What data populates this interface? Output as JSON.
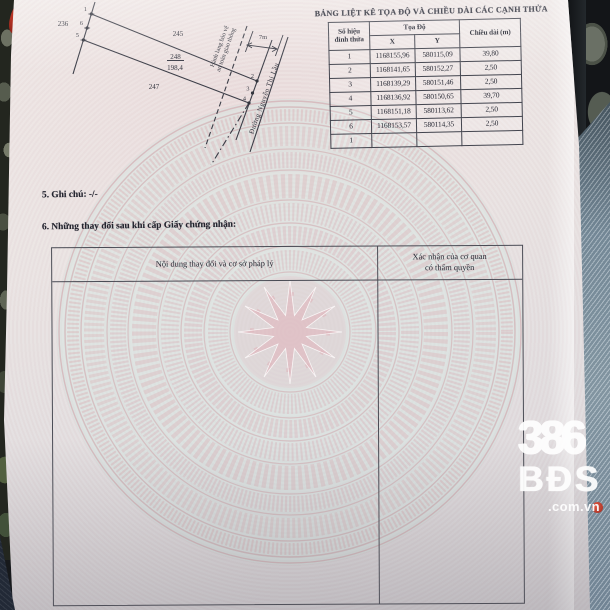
{
  "map": {
    "adjacent_left": "236",
    "adjacent_top": "245",
    "adjacent_bottom": "247",
    "parcel_number": "248",
    "parcel_area": "198,4",
    "road_width": "7m",
    "corridor_line1": "Hành lang bảo vệ",
    "corridor_line2": "an toàn giao thông",
    "road_name": "Đường Nguyễn Thị Lầu",
    "v1": "1",
    "v2": "2",
    "v3": "3",
    "v4": "4",
    "v5": "5",
    "v6": "6"
  },
  "coord_table": {
    "title": "BẢNG LIỆT KÊ TỌA ĐỘ VÀ CHIỀU DÀI CÁC CẠNH THỬA",
    "col_vertex_line1": "Số hiệu",
    "col_vertex_line2": "đỉnh thửa",
    "col_coords": "Tọa Độ",
    "col_x": "X",
    "col_y": "Y",
    "col_length": "Chiều dài (m)",
    "rows": [
      {
        "no": "1",
        "x": "1168155,96",
        "y": "580115,09",
        "len": "39,80"
      },
      {
        "no": "2",
        "x": "1168141,65",
        "y": "580152,27",
        "len": "2,50"
      },
      {
        "no": "3",
        "x": "1168139,29",
        "y": "580151,46",
        "len": "2,50"
      },
      {
        "no": "4",
        "x": "1168136,92",
        "y": "580150,65",
        "len": "39,70"
      },
      {
        "no": "5",
        "x": "1168151,18",
        "y": "580113,62",
        "len": "2,50"
      },
      {
        "no": "6",
        "x": "1168153,57",
        "y": "580114,35",
        "len": "2,50"
      },
      {
        "no": "1",
        "x": "",
        "y": "",
        "len": ""
      }
    ]
  },
  "sections": {
    "note": "5. Ghi chú: -/-",
    "changes_heading": "6. Những thay đổi sau khi cấp Giấy chứng nhận:"
  },
  "changes_table": {
    "col_content": "Nội dung thay đổi và cơ sở pháp lý",
    "col_confirm_line1": "Xác nhận của cơ quan",
    "col_confirm_line2": "có thẩm quyền"
  },
  "watermark": {
    "number": "386",
    "brand": "BĐS",
    "domain": ".com.vn"
  },
  "colors": {
    "paper": "#eae4e3",
    "drum_pink": "#dfb6bc",
    "table_line": "#42444e",
    "denim": "#8295a3",
    "logo_red": "#c0392b"
  }
}
